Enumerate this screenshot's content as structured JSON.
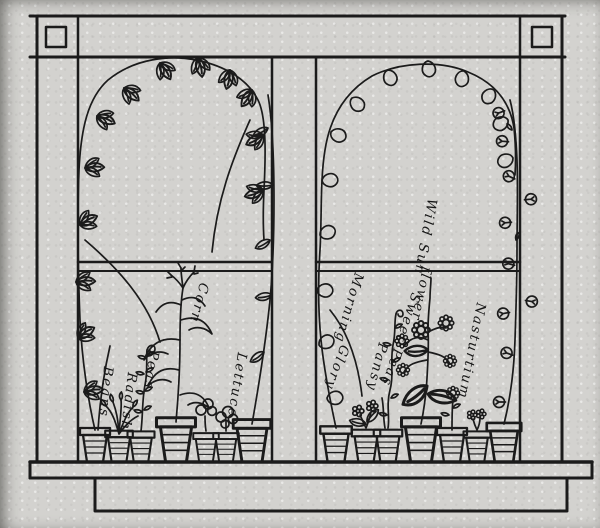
{
  "illustration": {
    "kind": "window-garden line drawing",
    "ink_color": "#1b1b1b",
    "paper_color": "#d3d2cf"
  },
  "plant_labels": {
    "beans": "Beans",
    "radish": "Radish",
    "peas": "Peas",
    "corn": "Corn",
    "lettuce": "Lettuce",
    "morning": "Morning",
    "glory": "Glory",
    "sweet_peas": "Sweet Peas",
    "pansy": "Pansy",
    "wild_sun": "Wild Sun",
    "flower": "flower",
    "nasturtium": "Nasturtium"
  }
}
